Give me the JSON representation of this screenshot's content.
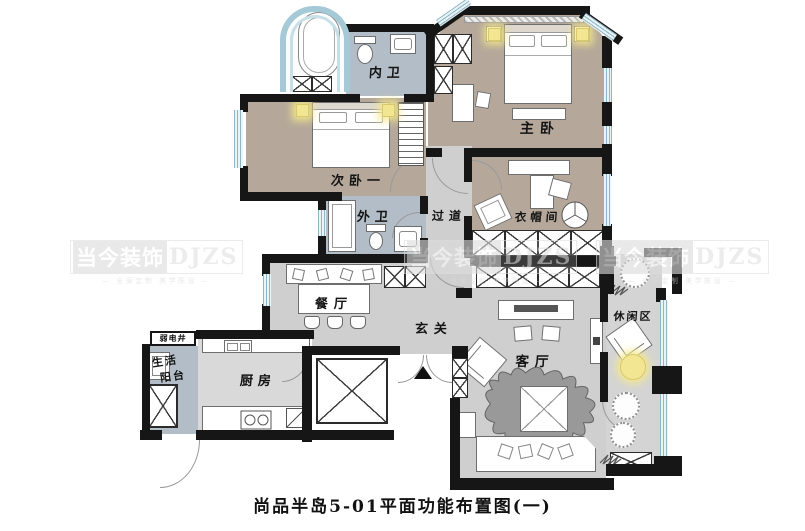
{
  "caption": "尚品半岛5-01平面功能布置图(一)",
  "watermark": {
    "brand": "当今装饰",
    "abbr": "DJZS",
    "tagline": "— 全案定制 美学陈设 —"
  },
  "rooms": {
    "master_bedroom": "主卧",
    "second_bedroom": "次卧一",
    "inner_bath": "内卫",
    "outer_bath": "外卫",
    "corridor": "过道",
    "cloakroom": "衣帽间",
    "dining": "餐厅",
    "foyer": "玄关",
    "utility_shaft": "弱电井",
    "balcony_line1": "生活",
    "balcony_line2": "阳台",
    "kitchen": "厨房",
    "living": "客厅",
    "leisure": "休闲区"
  },
  "colors": {
    "wall": "#161616",
    "bed_floor": "#b5a89a",
    "bath_floor": "#b2bdc7",
    "hall_floor": "#cfcfcf",
    "window_blue": "#cfe6ee",
    "accent_light": "#f3e693"
  }
}
